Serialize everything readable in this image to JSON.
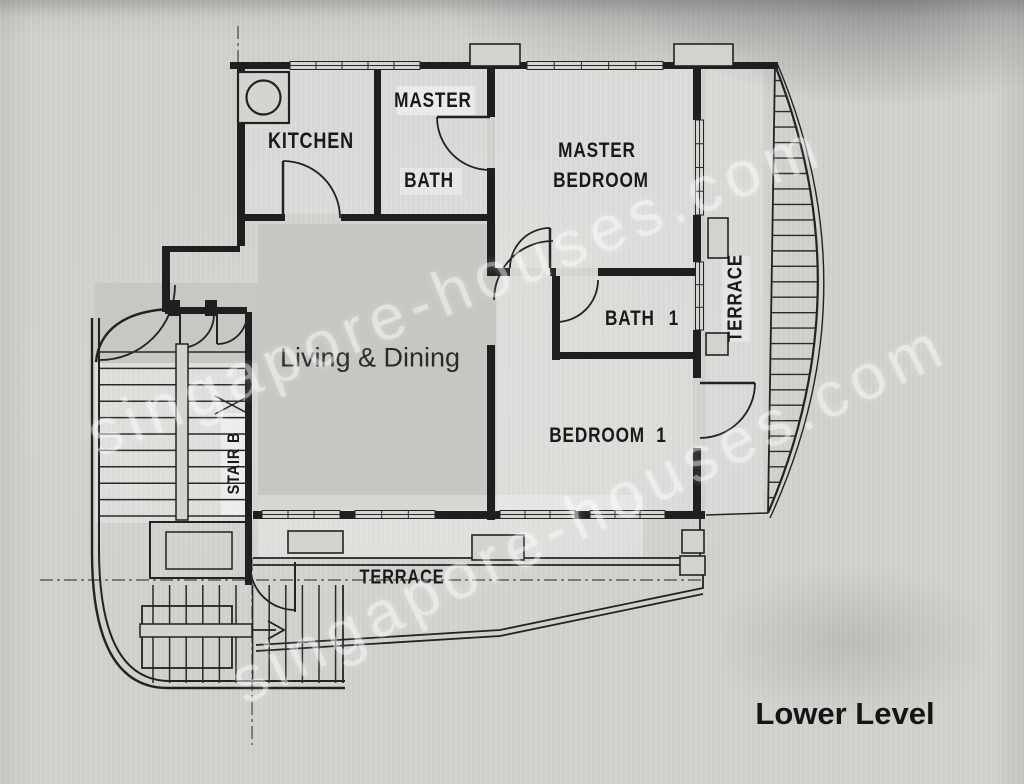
{
  "meta": {
    "document_type": "scanned floor plan photograph",
    "level_title": "Lower Level"
  },
  "colors": {
    "paper": "#d3d1ce",
    "ink": "#1f1f1f",
    "floor_patch": "#c8c6c2",
    "watermark": "rgba(255,255,255,0.42)"
  },
  "labels": {
    "kitchen": "KITCHEN",
    "master_bath_line1": "MASTER",
    "master_bath_line2": "BATH",
    "master_bedroom_line1": "MASTER",
    "master_bedroom_line2": "BEDROOM",
    "bath1": "BATH 1",
    "bedroom1": "BEDROOM 1",
    "living_dining": "Living & Dining",
    "stair": "STAIR B",
    "terrace_right": "TERRACE",
    "terrace_bottom": "TERRACE",
    "level_title": "Lower Level",
    "watermark": "singapore-houses.com"
  }
}
